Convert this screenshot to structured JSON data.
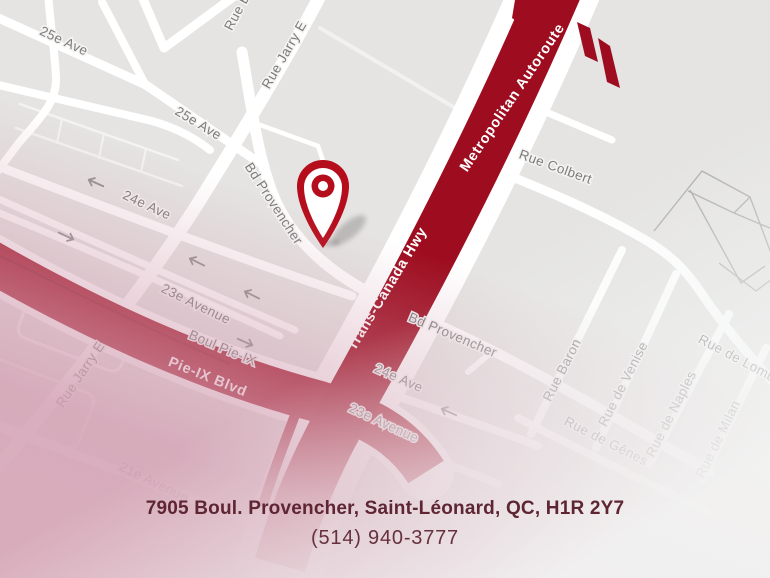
{
  "map": {
    "colors": {
      "background": "#e5e4e2",
      "road": "#ffffff",
      "highway_red": "#9d0d1f",
      "boulevard_red": "#a11123",
      "street_label": "#7b7b7b",
      "building_line": "#aeaeae",
      "highway_label_text": "#ffffff",
      "pin_red": "#b60d1c",
      "fade_pink": "#d4a3b7"
    },
    "street_labels": [
      {
        "text": "25e Ave"
      },
      {
        "text": "25e Ave"
      },
      {
        "text": "Rue B"
      },
      {
        "text": "Rue Jarry E"
      },
      {
        "text": "Bd Provencher"
      },
      {
        "text": "24e Ave"
      },
      {
        "text": "23e Avenue"
      },
      {
        "text": "Rue Jarry E"
      },
      {
        "text": "Boul Pie-IX"
      },
      {
        "text": "21e Avenue"
      },
      {
        "text": "Rue Colbert"
      },
      {
        "text": "Bd Provencher"
      },
      {
        "text": "24e Ave"
      },
      {
        "text": "23e Avenue"
      },
      {
        "text": "Rue Baron"
      },
      {
        "text": "Rue de Venise"
      },
      {
        "text": "Rue de Naples"
      },
      {
        "text": "Rue de Milan"
      },
      {
        "text": "Rue de Lomb"
      },
      {
        "text": "Rue de Gênes"
      }
    ],
    "highway_labels": [
      {
        "text": "Trans-Canada Hwy"
      },
      {
        "text": "Metropolitan Autoroute"
      },
      {
        "text": "Pie-IX Blvd"
      }
    ],
    "pin": {
      "icon": "map-pin-icon",
      "color": "#b60d1c"
    }
  },
  "footer": {
    "address": "7905 Boul. Provencher, Saint-Léonard, QC, H1R 2Y7",
    "phone": "(514) 940-3777",
    "text_color": "#5e2533"
  }
}
